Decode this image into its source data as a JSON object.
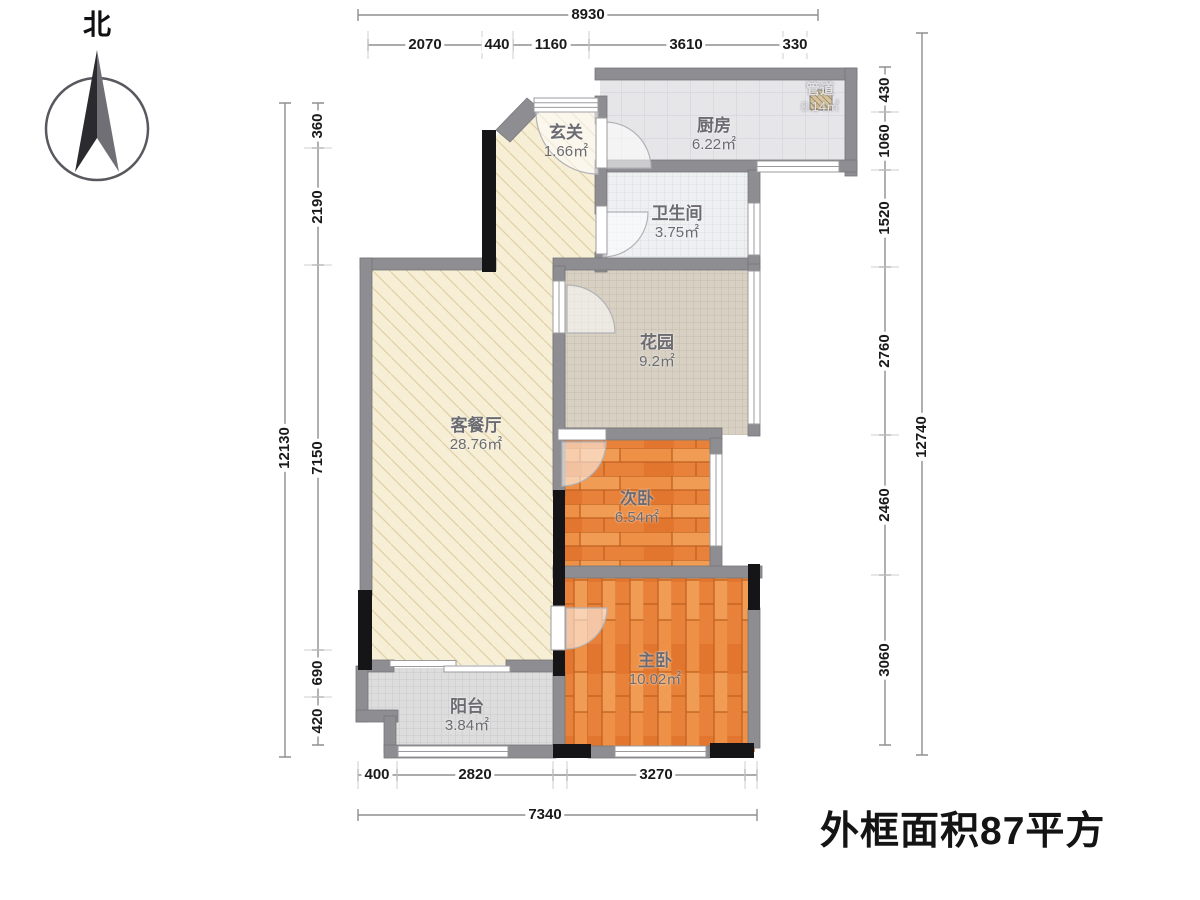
{
  "compass": {
    "north_label": "北"
  },
  "footer": {
    "outer_area_note": "外框面积87平方"
  },
  "rooms": {
    "entry": {
      "name": "玄关",
      "area": "1.66㎡"
    },
    "kitchen": {
      "name": "厨房",
      "area": "6.22㎡"
    },
    "duct": {
      "name": "管道",
      "area": "0.14㎡"
    },
    "bathroom": {
      "name": "卫生间",
      "area": "3.75㎡"
    },
    "garden": {
      "name": "花园",
      "area": "9.2㎡"
    },
    "living_dining": {
      "name": "客餐厅",
      "area": "28.76㎡"
    },
    "second_bedroom": {
      "name": "次卧",
      "area": "6.54㎡"
    },
    "master_bedroom": {
      "name": "主卧",
      "area": "10.02㎡"
    },
    "balcony": {
      "name": "阳台",
      "area": "3.84㎡"
    }
  },
  "dimensions_mm": {
    "top": {
      "total": "8930",
      "segments": [
        "2070",
        "440",
        "1160",
        "3610",
        "330"
      ]
    },
    "left": {
      "total": "12130",
      "segments": [
        "360",
        "2190",
        "7150",
        "690",
        "420"
      ]
    },
    "right": {
      "total": "12740",
      "segments": [
        "430",
        "1060",
        "1520",
        "2760",
        "2460",
        "3060"
      ]
    },
    "bottom": {
      "total": "7340",
      "segments": [
        "400",
        "2820",
        "3270"
      ]
    }
  },
  "colors": {
    "wall_gray": "#8e8e92",
    "wall_black": "#151517",
    "living_floor": "#f6eed5",
    "wood_floor": "#ec8c44",
    "kitchen_floor": "#e6e6e9",
    "garden_floor": "#d8d0c3",
    "balcony_floor": "#dddddd",
    "label_text": "#6b6b71",
    "dimension_text": "#1a1a1a"
  }
}
